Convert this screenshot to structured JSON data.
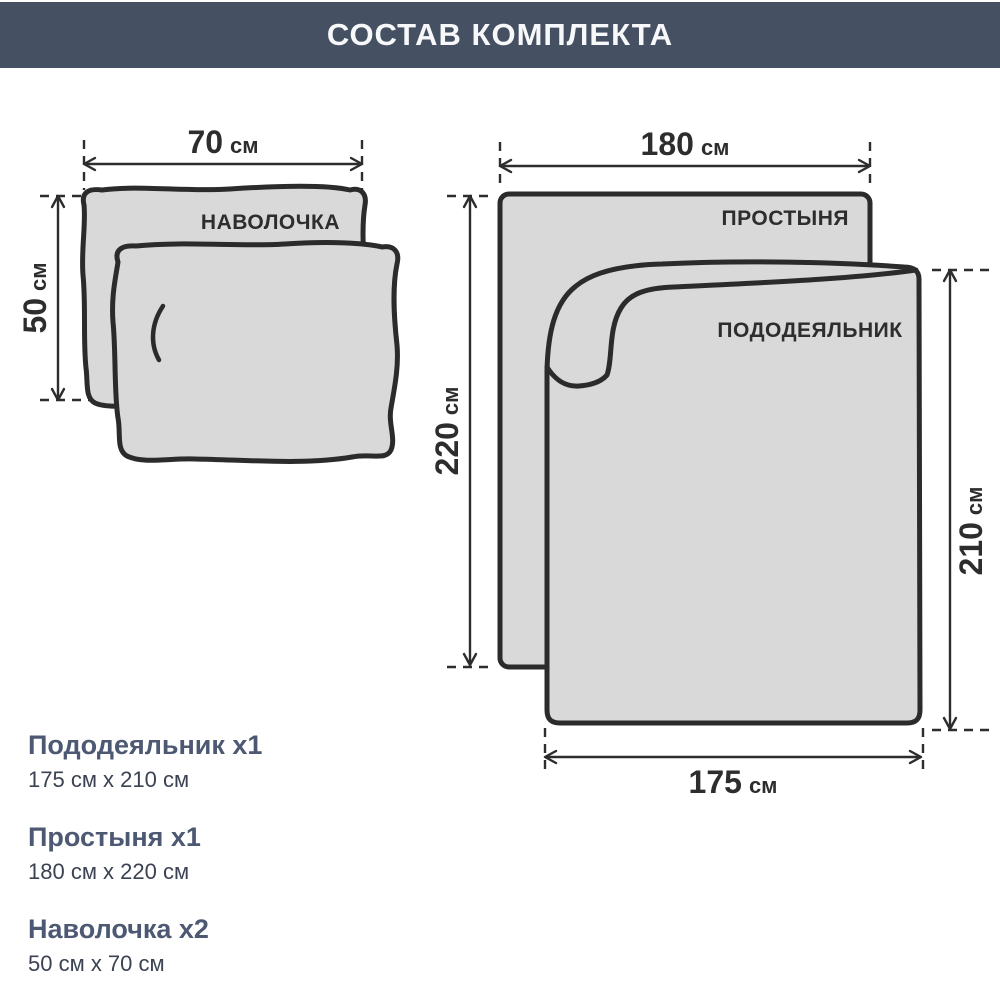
{
  "header": {
    "title": "СОСТАВ КОМПЛЕКТА"
  },
  "colors": {
    "header_bg": "#465063",
    "header_fg": "#f7f8fa",
    "shape_fill": "#d9d9d9",
    "outline": "#2b2b2b",
    "dimension": "#2d2d2d",
    "legend_heading": "#4d5873",
    "legend_size": "#3b4252",
    "page_bg": "#ffffff"
  },
  "items": {
    "pillowcase": {
      "label": "НАВОЛОЧКА",
      "width_value": "70",
      "width_unit": "см",
      "height_value": "50",
      "height_unit": "см"
    },
    "sheet": {
      "label": "ПРОСТЫНЯ",
      "width_value": "180",
      "width_unit": "см",
      "height_value": "220",
      "height_unit": "см"
    },
    "duvet": {
      "label": "ПОДОДЕЯЛЬНИК",
      "width_value": "175",
      "width_unit": "см",
      "height_value": "210",
      "height_unit": "см"
    }
  },
  "legend": {
    "items": [
      {
        "name": "Пододеяльник x1",
        "size": "175 см x 210 см"
      },
      {
        "name": "Простыня x1",
        "size": "180 см x 220 см"
      },
      {
        "name": "Наволочка x2",
        "size": "50 см x 70 см"
      }
    ]
  }
}
